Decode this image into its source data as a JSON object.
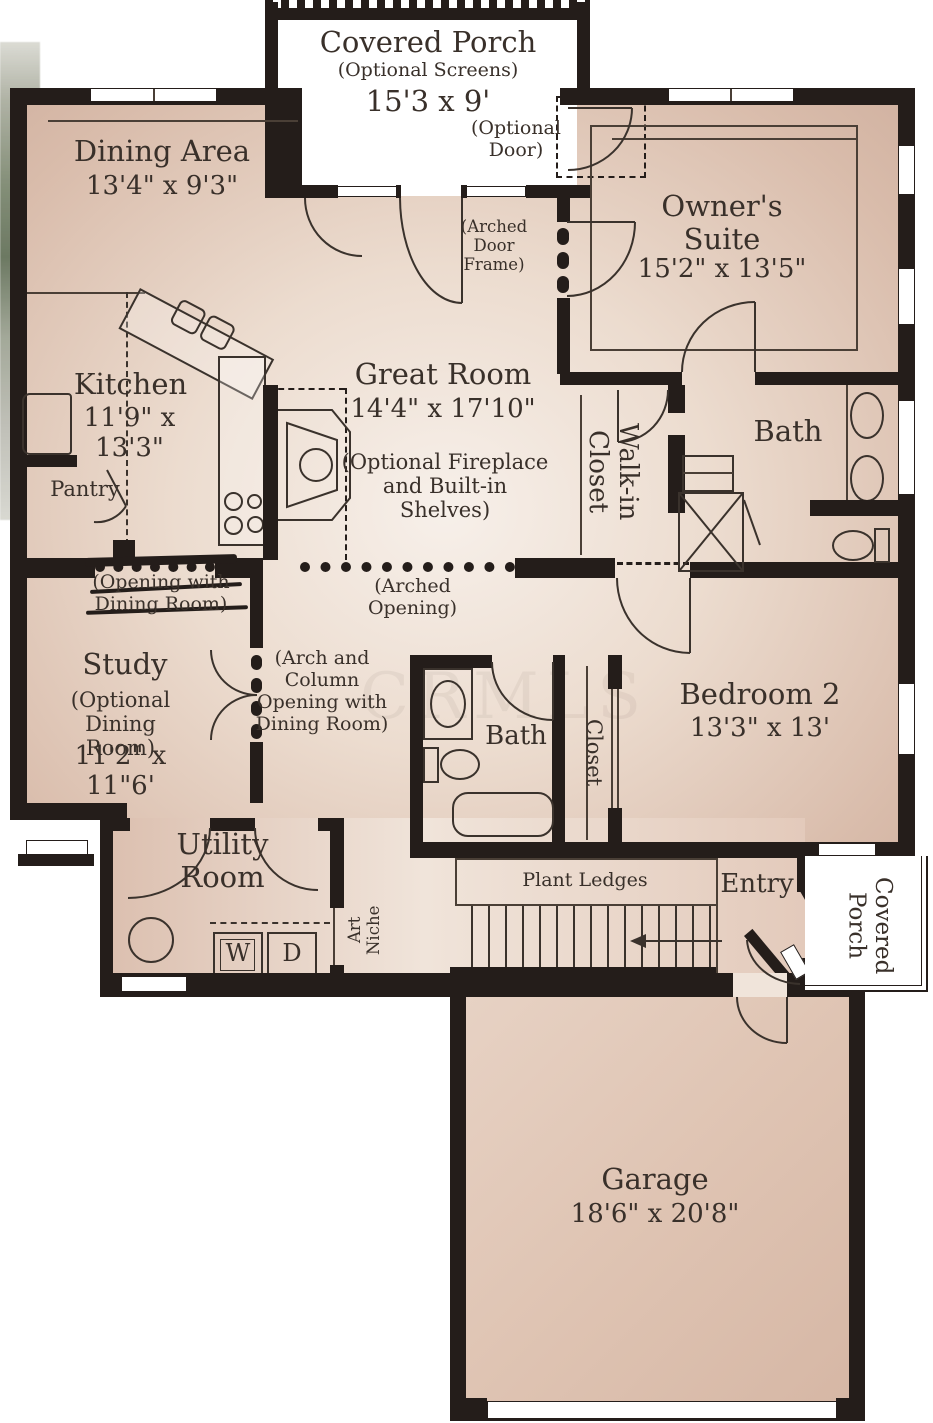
{
  "colors": {
    "wall": "#241d1a",
    "floor_dark": "#d5b8a7",
    "floor_light": "#f6efe9",
    "text": "#39302a"
  },
  "rooms": {
    "covered_porch_top": {
      "name": "Covered Porch",
      "note": "(Optional Screens)",
      "dims": "15'3 x 9'"
    },
    "dining": {
      "name": "Dining Area",
      "dims": "13'4\" x 9'3\""
    },
    "owners_suite": {
      "name": "Owner's Suite",
      "dims": "15'2\" x 13'5\""
    },
    "kitchen": {
      "name": "Kitchen",
      "dims": "11'9\" x 13'3\""
    },
    "great_room": {
      "name": "Great Room",
      "dims": "14'4\" x 17'10\"",
      "note": "(Optional Fireplace and Built-in Shelves)"
    },
    "pantry": {
      "name": "Pantry"
    },
    "walk_in_closet": {
      "name": "Walk-in Closet"
    },
    "owners_bath": {
      "name": "Bath"
    },
    "study": {
      "name": "Study",
      "note": "(Optional Dining Room)",
      "dims": "11'2\" x 11\"6'"
    },
    "bath2": {
      "name": "Bath"
    },
    "closet2": {
      "name": "Closet"
    },
    "bedroom2": {
      "name": "Bedroom 2",
      "dims": "13'3\" x 13'"
    },
    "utility": {
      "name": "Utility Room"
    },
    "entry": {
      "name": "Entry"
    },
    "covered_porch_right": {
      "name": "Covered Porch"
    },
    "garage": {
      "name": "Garage",
      "dims": "18'6\" x 20'8\""
    }
  },
  "annotations": {
    "optional_door": "(Optional Door)",
    "arched_door_frame": "(Arched Door Frame)",
    "arched_opening": "(Arched Opening)",
    "opening_with_dining": "(Opening with Dining Room)",
    "arch_column_note": "(Arch and Column Opening with Dining Room)",
    "plant_ledges": "Plant Ledges",
    "art_niche": "Art Niche",
    "washer": "W",
    "dryer": "D",
    "watermark": "CRMLS"
  }
}
